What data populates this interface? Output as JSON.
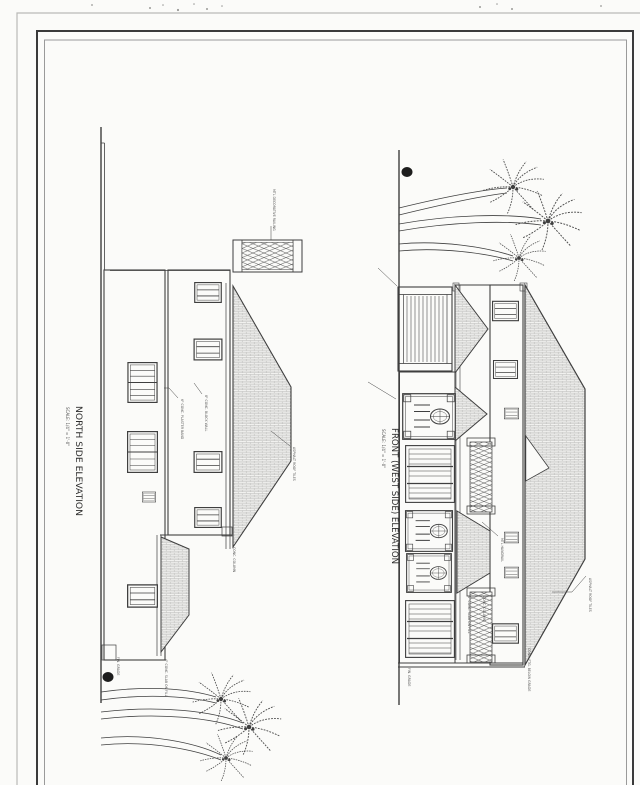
{
  "sheet": {
    "background": "#fbfbf9",
    "line_color": "#3f3f3f",
    "frame_outer_color": "#3a3a3a",
    "frame_inner_color": "#9a9a9a",
    "paper_edge_color": "#b9b9b7",
    "hatch_color": "#b0b0ae"
  },
  "north_elevation": {
    "title": "NORTH SIDE ELEVATION",
    "scale": "SCALE: 1/4\" = 1'-0\"",
    "annotations": {
      "railing": "MTL DECORATIVE RAILING",
      "band": "6\" CONC. PLASTER BAND",
      "wall": "8\" CONC. BLOCK WALL",
      "roof": "ASPHALT ROOF TILES",
      "grade": "FIN. GRADE",
      "slab": "4\" CONC. SLAB ON FILL",
      "column": "CONC. COLUMN"
    }
  },
  "front_elevation": {
    "title": "FRONT (WEST SIDE) ELEVATION",
    "scale": "SCALE: 1/4\" = 1'-0\"",
    "annotations": {
      "handrail": "MTL HANDRAIL",
      "roof": "ASPHALT ROOF TILES",
      "grade": "FIN. GRADE",
      "slab": "4\" CONC. SLAB ON FILL",
      "column": "CONC. COLUMN",
      "footing": "CONC. FTG. BELOW GRADE"
    }
  }
}
